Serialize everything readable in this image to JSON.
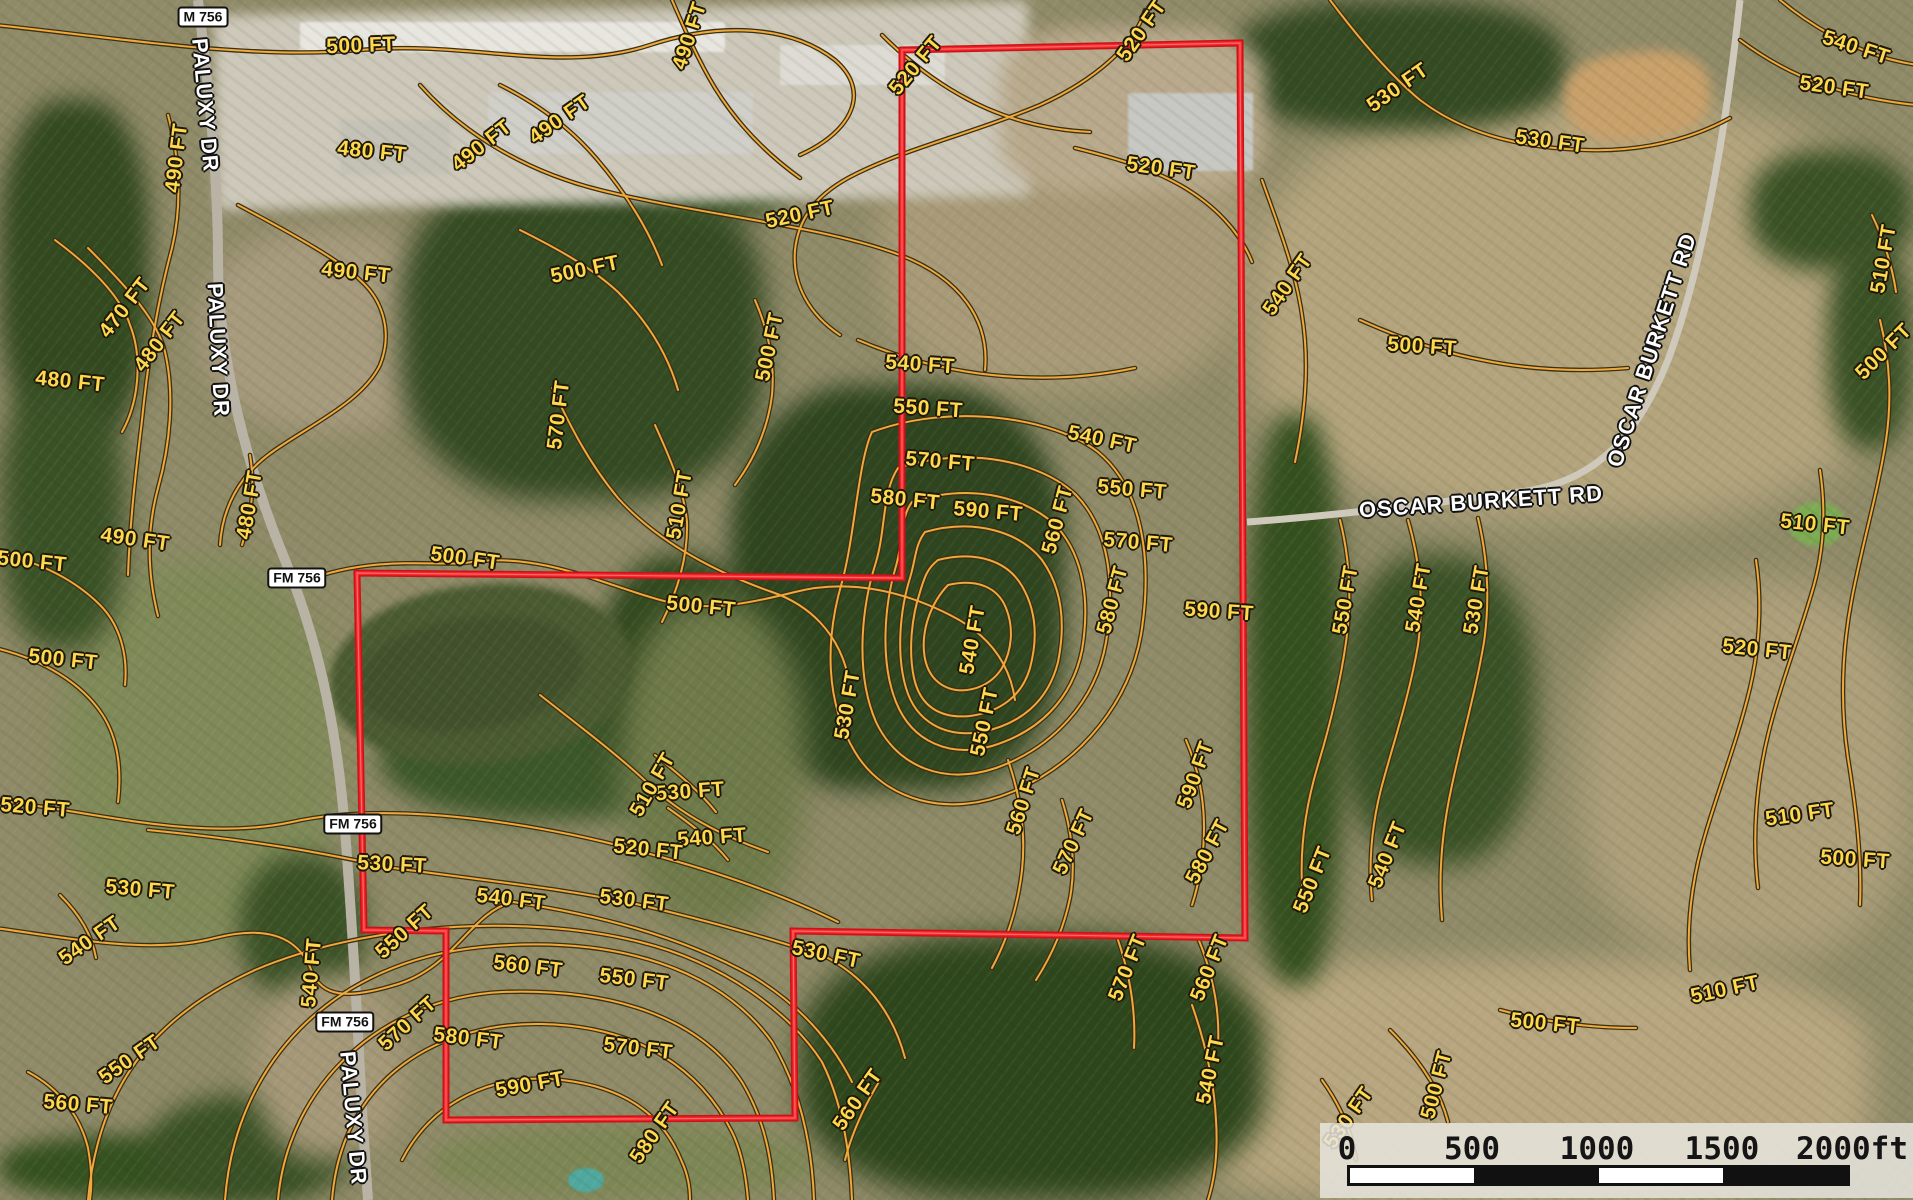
{
  "map_title": "Topographic contour overlay on aerial imagery with property boundary",
  "colors": {
    "contour_line": "#f0a93c",
    "contour_halo": "#3a3014",
    "contour_label": "#ffd84e",
    "boundary_red": "#f3242a",
    "boundary_edge": "#c81418",
    "road_label": "#ffffff",
    "scalebar_panel": "rgba(232,229,222,0.85)"
  },
  "parcel_boundary": {
    "points": "902,50 1240,43 1245,938 793,931 795,1118 446,1120 446,931 364,930 357,573 902,578"
  },
  "route_badges": [
    {
      "label": "M 756",
      "x": 203,
      "y": 17
    },
    {
      "label": "FM 756",
      "x": 297,
      "y": 578
    },
    {
      "label": "FM 756",
      "x": 353,
      "y": 824
    },
    {
      "label": "FM 756",
      "x": 345,
      "y": 1022
    }
  ],
  "road_labels": [
    {
      "label": "PALUXY DR",
      "x": 205,
      "y": 105,
      "rot": 85
    },
    {
      "label": "PALUXY DR",
      "x": 218,
      "y": 350,
      "rot": 87
    },
    {
      "label": "PALUXY DR",
      "x": 353,
      "y": 1118,
      "rot": 85
    },
    {
      "label": "OSCAR BURKETT RD",
      "x": 1481,
      "y": 502,
      "rot": -4
    },
    {
      "label": "OSCAR BURKETT RD",
      "x": 1652,
      "y": 350,
      "rot": -72
    }
  ],
  "contour_labels": [
    {
      "t": "500 FT",
      "x": 361,
      "y": 46,
      "r": -2
    },
    {
      "t": "490 FT",
      "x": 177,
      "y": 158,
      "r": -83
    },
    {
      "t": "480 FT",
      "x": 372,
      "y": 152,
      "r": 6
    },
    {
      "t": "490 FT",
      "x": 482,
      "y": 146,
      "r": -38
    },
    {
      "t": "490 FT",
      "x": 690,
      "y": 36,
      "r": -72
    },
    {
      "t": "520 FT",
      "x": 916,
      "y": 66,
      "r": -50
    },
    {
      "t": "520 FT",
      "x": 1142,
      "y": 31,
      "r": -55
    },
    {
      "t": "520 FT",
      "x": 1161,
      "y": 169,
      "r": 8
    },
    {
      "t": "530 FT",
      "x": 1398,
      "y": 88,
      "r": -35
    },
    {
      "t": "530 FT",
      "x": 1550,
      "y": 142,
      "r": 8
    },
    {
      "t": "540 FT",
      "x": 1856,
      "y": 48,
      "r": 18
    },
    {
      "t": "520 FT",
      "x": 1834,
      "y": 88,
      "r": 8
    },
    {
      "t": "510 FT",
      "x": 1884,
      "y": 259,
      "r": -80
    },
    {
      "t": "500 FT",
      "x": 1884,
      "y": 352,
      "r": -45
    },
    {
      "t": "470 FT",
      "x": 125,
      "y": 308,
      "r": -52
    },
    {
      "t": "480 FT",
      "x": 160,
      "y": 342,
      "r": -52
    },
    {
      "t": "490 FT",
      "x": 356,
      "y": 273,
      "r": 6
    },
    {
      "t": "480 FT",
      "x": 70,
      "y": 382,
      "r": 6
    },
    {
      "t": "490 FT",
      "x": 135,
      "y": 540,
      "r": 8
    },
    {
      "t": "500 FT",
      "x": 32,
      "y": 562,
      "r": 6
    },
    {
      "t": "500 FT",
      "x": 63,
      "y": 660,
      "r": 6
    },
    {
      "t": "480 FT",
      "x": 250,
      "y": 505,
      "r": -80
    },
    {
      "t": "500 FT",
      "x": 465,
      "y": 559,
      "r": 8
    },
    {
      "t": "500 FT",
      "x": 701,
      "y": 607,
      "r": 6
    },
    {
      "t": "510 FT",
      "x": 680,
      "y": 505,
      "r": -80
    },
    {
      "t": "570 FT",
      "x": 559,
      "y": 415,
      "r": -83
    },
    {
      "t": "500 FT",
      "x": 770,
      "y": 347,
      "r": -78
    },
    {
      "t": "490 FT",
      "x": 560,
      "y": 120,
      "r": -35
    },
    {
      "t": "500 FT",
      "x": 585,
      "y": 270,
      "r": -12
    },
    {
      "t": "520 FT",
      "x": 800,
      "y": 215,
      "r": -12
    },
    {
      "t": "540 FT",
      "x": 920,
      "y": 365,
      "r": 4
    },
    {
      "t": "550 FT",
      "x": 928,
      "y": 409,
      "r": 4
    },
    {
      "t": "570 FT",
      "x": 940,
      "y": 462,
      "r": 5
    },
    {
      "t": "580 FT",
      "x": 905,
      "y": 500,
      "r": 6
    },
    {
      "t": "590 FT",
      "x": 988,
      "y": 512,
      "r": 5
    },
    {
      "t": "540 FT",
      "x": 1102,
      "y": 440,
      "r": 12
    },
    {
      "t": "550 FT",
      "x": 1132,
      "y": 490,
      "r": 5
    },
    {
      "t": "570 FT",
      "x": 1138,
      "y": 543,
      "r": 5
    },
    {
      "t": "560 FT",
      "x": 1058,
      "y": 520,
      "r": -75
    },
    {
      "t": "580 FT",
      "x": 1113,
      "y": 600,
      "r": -75
    },
    {
      "t": "590 FT",
      "x": 1219,
      "y": 612,
      "r": 4
    },
    {
      "t": "590 FT",
      "x": 1196,
      "y": 775,
      "r": -70
    },
    {
      "t": "580 FT",
      "x": 1208,
      "y": 852,
      "r": -62
    },
    {
      "t": "570 FT",
      "x": 1074,
      "y": 842,
      "r": -65
    },
    {
      "t": "560 FT",
      "x": 1024,
      "y": 801,
      "r": -72
    },
    {
      "t": "550 FT",
      "x": 985,
      "y": 722,
      "r": -78
    },
    {
      "t": "540 FT",
      "x": 973,
      "y": 640,
      "r": -80
    },
    {
      "t": "530 FT",
      "x": 848,
      "y": 705,
      "r": -80
    },
    {
      "t": "540 FT",
      "x": 1288,
      "y": 285,
      "r": -55
    },
    {
      "t": "500 FT",
      "x": 1422,
      "y": 347,
      "r": 4
    },
    {
      "t": "550 FT",
      "x": 1346,
      "y": 600,
      "r": -80
    },
    {
      "t": "540 FT",
      "x": 1419,
      "y": 598,
      "r": -80
    },
    {
      "t": "530 FT",
      "x": 1477,
      "y": 600,
      "r": -80
    },
    {
      "t": "540 FT",
      "x": 1388,
      "y": 855,
      "r": -68
    },
    {
      "t": "550 FT",
      "x": 1313,
      "y": 880,
      "r": -68
    },
    {
      "t": "510 FT",
      "x": 1815,
      "y": 525,
      "r": 6
    },
    {
      "t": "520 FT",
      "x": 1757,
      "y": 650,
      "r": 6
    },
    {
      "t": "510 FT",
      "x": 1800,
      "y": 815,
      "r": -8
    },
    {
      "t": "510 FT",
      "x": 1725,
      "y": 990,
      "r": -12
    },
    {
      "t": "500 FT",
      "x": 1855,
      "y": 860,
      "r": 4
    },
    {
      "t": "530 FT",
      "x": 690,
      "y": 792,
      "r": -4
    },
    {
      "t": "540 FT",
      "x": 712,
      "y": 838,
      "r": -4
    },
    {
      "t": "510 FT",
      "x": 653,
      "y": 785,
      "r": -60
    },
    {
      "t": "520 FT",
      "x": 648,
      "y": 850,
      "r": 6
    },
    {
      "t": "520 FT",
      "x": 35,
      "y": 808,
      "r": 5
    },
    {
      "t": "530 FT",
      "x": 140,
      "y": 890,
      "r": 5
    },
    {
      "t": "540 FT",
      "x": 90,
      "y": 941,
      "r": -35
    },
    {
      "t": "550 FT",
      "x": 130,
      "y": 1060,
      "r": -35
    },
    {
      "t": "560 FT",
      "x": 78,
      "y": 1105,
      "r": 5
    },
    {
      "t": "540 FT",
      "x": 312,
      "y": 973,
      "r": -85
    },
    {
      "t": "550 FT",
      "x": 405,
      "y": 932,
      "r": -42
    },
    {
      "t": "530 FT",
      "x": 392,
      "y": 865,
      "r": 3
    },
    {
      "t": "540 FT",
      "x": 511,
      "y": 900,
      "r": 7
    },
    {
      "t": "530 FT",
      "x": 634,
      "y": 901,
      "r": 7
    },
    {
      "t": "560 FT",
      "x": 528,
      "y": 967,
      "r": 7
    },
    {
      "t": "550 FT",
      "x": 634,
      "y": 980,
      "r": 7
    },
    {
      "t": "570 FT",
      "x": 408,
      "y": 1024,
      "r": -42
    },
    {
      "t": "580 FT",
      "x": 468,
      "y": 1039,
      "r": 7
    },
    {
      "t": "570 FT",
      "x": 638,
      "y": 1049,
      "r": 7
    },
    {
      "t": "590 FT",
      "x": 530,
      "y": 1085,
      "r": -10
    },
    {
      "t": "580 FT",
      "x": 655,
      "y": 1133,
      "r": -55
    },
    {
      "t": "560 FT",
      "x": 858,
      "y": 1100,
      "r": -55
    },
    {
      "t": "570 FT",
      "x": 1128,
      "y": 968,
      "r": -68
    },
    {
      "t": "560 FT",
      "x": 1210,
      "y": 968,
      "r": -68
    },
    {
      "t": "530 FT",
      "x": 826,
      "y": 955,
      "r": 12
    },
    {
      "t": "500 FT",
      "x": 1545,
      "y": 1024,
      "r": 6
    },
    {
      "t": "500 FT",
      "x": 1437,
      "y": 1085,
      "r": -75
    },
    {
      "t": "530 FT",
      "x": 1349,
      "y": 1118,
      "r": -55
    },
    {
      "t": "540 FT",
      "x": 1211,
      "y": 1070,
      "r": -78
    }
  ],
  "scale_bar": {
    "ticks": [
      {
        "label": "0",
        "x": 1347
      },
      {
        "label": "500",
        "x": 1472
      },
      {
        "label": "1000",
        "x": 1597
      },
      {
        "label": "1500",
        "x": 1722
      },
      {
        "label": "2000ft",
        "x": 1852
      }
    ],
    "segments": [
      "w",
      "b",
      "w",
      "b"
    ]
  }
}
